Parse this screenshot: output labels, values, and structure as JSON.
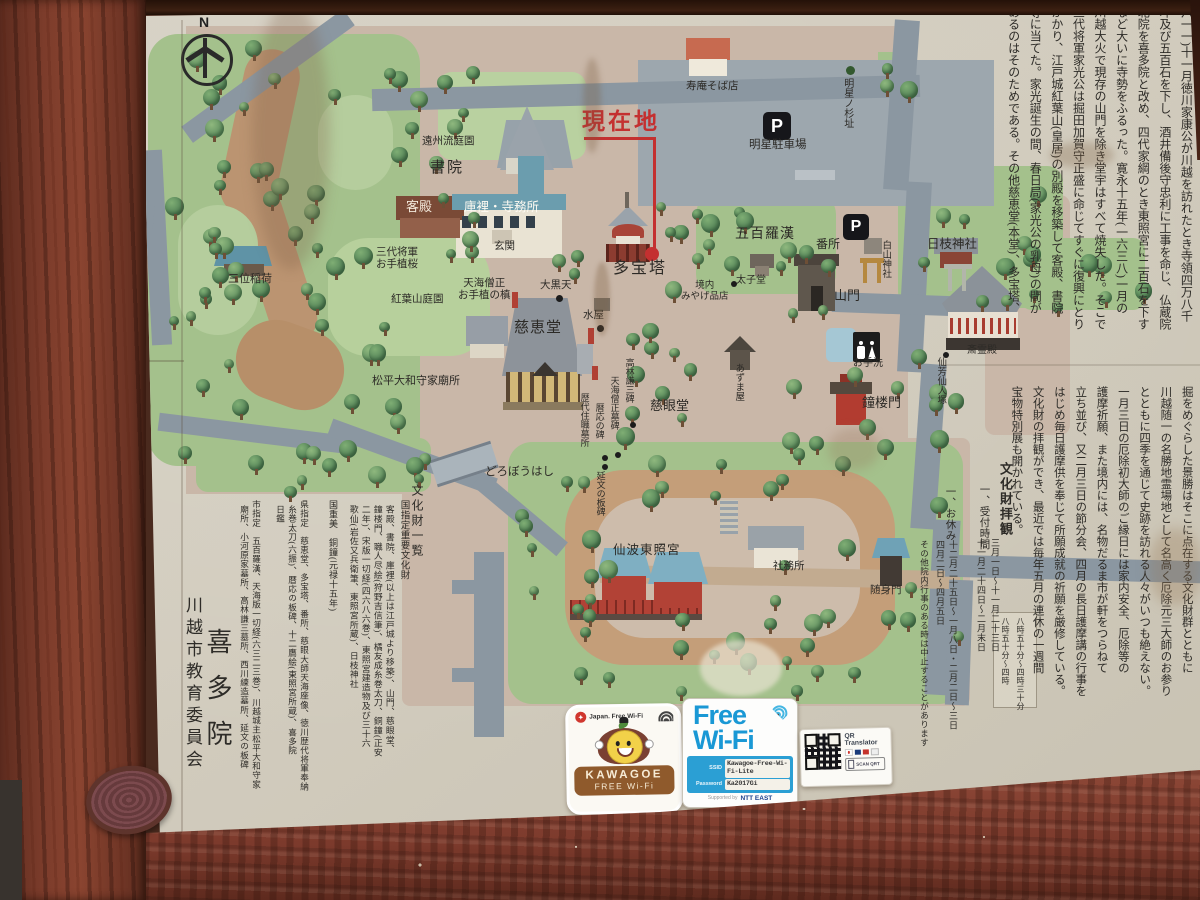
{
  "colors": {
    "accent_red": "#c43030",
    "board": "#d2ccbe",
    "wood": "#7b3b2b",
    "road": "#8b97a1",
    "green": "#a4c18c"
  },
  "compass": {
    "north": "N"
  },
  "icons": {
    "parking": "P"
  },
  "map_labels": {
    "genzaichi": "現在地",
    "tahoto": "多宝塔",
    "shoin": "書院",
    "kyakuden": "客殿",
    "kuri": "庫裡・寺務所",
    "genkan": "玄関",
    "enshu": "遠州流庭園",
    "sakura": "三代将軍\nお手植桜",
    "inari": "三位稲荷",
    "momiji": "紅葉山庭園",
    "maki": "天海僧正\nお手植の槙",
    "daikoku": "大黒天",
    "jikeido": "慈恵堂",
    "mizuya": "水屋",
    "soba": "寿庵そば店",
    "parking_lot": "明星駐車場",
    "sugi": "明星ノ杉址",
    "rakan": "五百羅漢",
    "bansho": "番所",
    "hakusan": "白山神社",
    "hie": "日枝神社",
    "sanmon": "山門",
    "otearai": "お手洗",
    "shoro": "鐘楼門",
    "sairei": "斎霊殿",
    "senpo": "仙芳仙人塚",
    "azumaya": "あずま屋",
    "taishi": "太子堂",
    "miyage": "境内\nみやげ品店",
    "jigen": "慈眼堂",
    "kobayashi": "高林謙三碑",
    "tenkaibo": "天海僧正墓碑",
    "ryakuo": "暦応の碑",
    "rekidai": "歴代住職墓所",
    "enbun": "延文の板碑",
    "matsudaira": "松平大和守家廟所",
    "dorobo": "どろぼうはし",
    "toshogu": "仙波東照宮",
    "shamusho": "社務所",
    "zuishin": "随身門"
  },
  "history_text": {
    "columns": [
      "(慈眼大師)が第二十七世の法統をつぐが、同十六年(一",
      "六一一)十一月徳川家康公が川越を訪れたとき寺領四万八千",
      "坪及び五百石を下し、酒井備後守忠利に工事を命じ、仏蔵院",
      "北院を喜多院と改め、四代家綱のとき東照宮に二百石を下す",
      "など大いに寺勢をふるった。寛永十五年(一六三八)一月の",
      "川越大火で現存の山門を除き堂宇はすべて焼失した。そこで",
      "三代将軍家光公は掘田加賀守正盛に命じてすぐに復興にとり",
      "かかり、江戸城紅葉山(皇居)の別殿を移築して客殿、書院",
      "等に当てた。家光誕生の間、春日局(家光公の乳母)の間が",
      "あるのはそのためである。その他慈恵堂(本堂)、多宝塔、"
    ]
  },
  "grounds_text": {
    "columns": [
      "その緑は市民にとって貴重な憩いの場となっており池や",
      "掘をめぐらした景勝はそこに点在する文化財群とともに",
      "川越随一の名勝地霊場地として名高く厄除元三大師のお参り",
      "とともに四季を通じて史跡を訪れる人々がいつも絶えない。",
      "一月三日の厄除初大師のご縁日には家内安全、厄除等の",
      "護摩祈願、また境内には、名物だるま市が軒をつらねて",
      "立ち並び、又二月三日の節分会、四月の長日護摩講の行事を",
      "はじめ毎日護摩供を奉じて所願成就の祈願を厳修している。",
      "文化財の拝観ができ、最近では毎年五月の連休の一週間",
      "宝物特別展も開かれている。"
    ]
  },
  "visit_info": {
    "title": "文化財拝観",
    "reception_label": "一、受付時間",
    "reception_periods": [
      "三月一日～十一月二十三日",
      "十一月二十四日～二月末日"
    ],
    "reception_hours": [
      "八時五十分～四時三十分",
      "八時五十分～四時"
    ],
    "holiday_label": "一、お休み",
    "holidays": [
      "十二月二十五日～一月八日・二月二日～三日",
      "四月二日～四月五日"
    ],
    "note": "その他院内行事のある時は中止することがあります"
  },
  "legend": {
    "title": "文化財一覧",
    "national_header": "国指定重要文化財",
    "national_lines": [
      "客殿、書院、庫裡(以上は江戸城より移築)、山門、慈眼堂、",
      "鐘楼門、職人尽絵(狩野吉信筆)、橘友成糸巻太刀、銅鐘(正安",
      "二年)、宋版一切経(四六八六巻)、東照宮建造物及び三十六",
      "歌仙(岩佐又兵衛筆、東照宮所蔵)、日枝神社"
    ],
    "kokujubi_line": "国重美　銅鐘(元禄十五年)",
    "pref_lines": [
      "県指定　慈恵堂、多宝塔、番所、慈眼大師天海座像、徳川歴代将軍奉納",
      "糸巻太刀(六振)、暦応の板碑、十二鷹絵(東照宮所蔵)、喜多院",
      "日鑑"
    ],
    "city_lines": [
      "市指定　五百羅漢、天海版一切経(六三二三巻)、川越城主松平大和守家",
      "廟所、小河原家墓所、高林謙三墓所、西川練造墓所、延文の板碑"
    ]
  },
  "signature": {
    "temple": "喜多院",
    "committee": "川越市教育委員会"
  },
  "stickers": {
    "kawagoe": {
      "brand": "Japan. Free Wi-Fi",
      "name_line1": "KAWAGOE",
      "name_line2": "FREE Wi-Fi"
    },
    "freewifi": {
      "line1": "Free",
      "line2": "Wi-Fi",
      "ssid_label": "SSID",
      "ssid": "Kawagoe-Free-Wi-Fi-Lite",
      "password_label": "Password",
      "password": "Ka2017Gi",
      "supported": "Supported by",
      "provider": "NTT EAST"
    },
    "qr": {
      "title": "QR Translator",
      "scan": "SCAN QRT"
    }
  }
}
